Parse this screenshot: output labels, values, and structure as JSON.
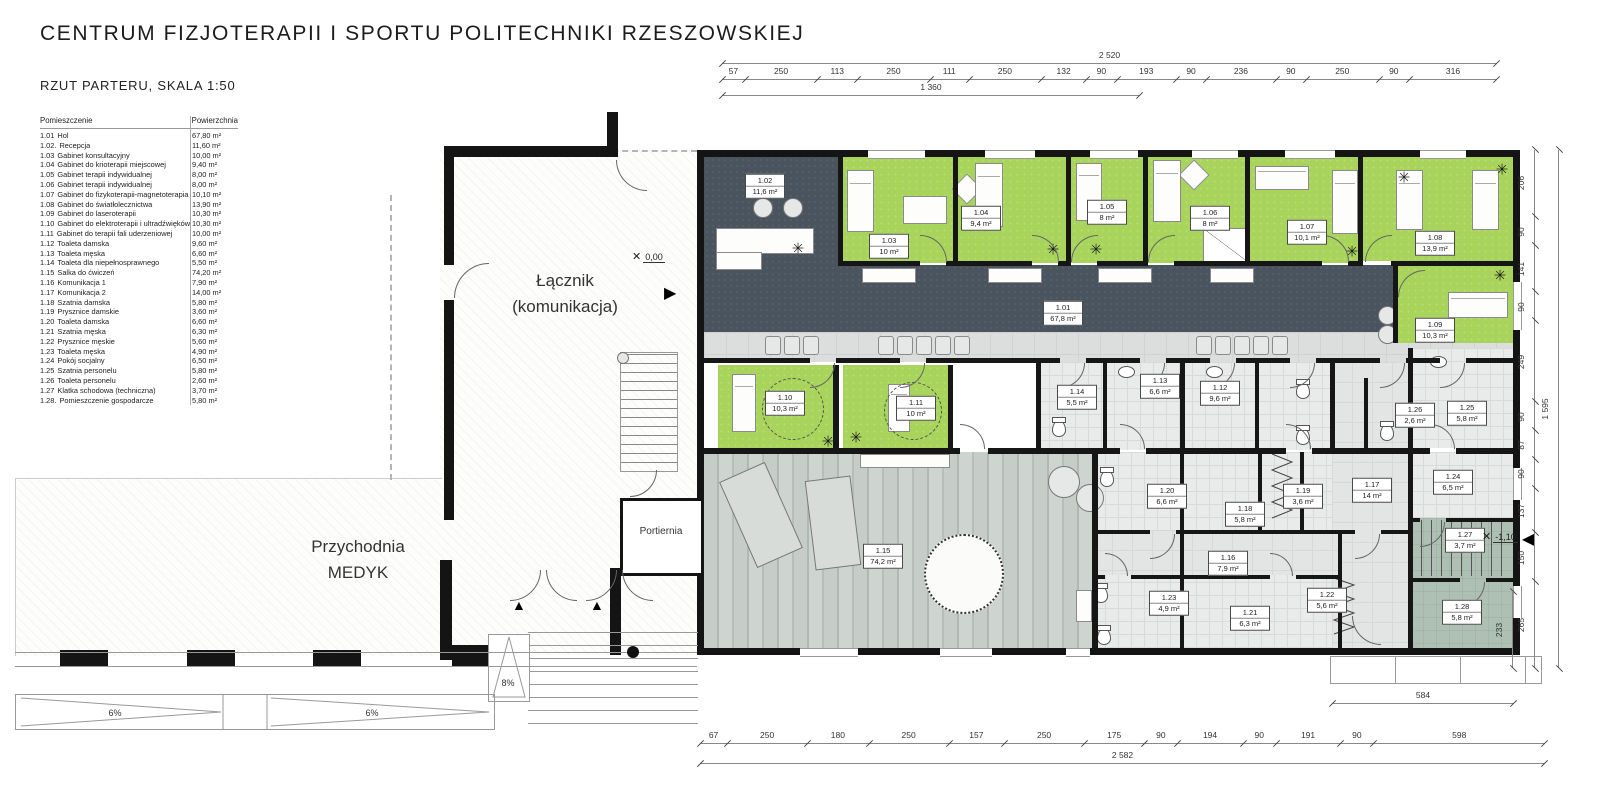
{
  "header": {
    "title": "CENTRUM FIZJOTERAPII I SPORTU POLITECHNIKI RZESZOWSKIEJ",
    "subtitle": "RZUT PARTERU, SKALA 1:50"
  },
  "legend": {
    "col_room": "Pomieszczenie",
    "col_area": "Powierzchnia",
    "rows": [
      {
        "id": "1.01",
        "name": "Hol",
        "area": "67,80 m²"
      },
      {
        "id": "1.02.",
        "name": "Recepcja",
        "area": "11,60 m²"
      },
      {
        "id": "1.03",
        "name": "Gabinet konsultacyjny",
        "area": "10,00 m²"
      },
      {
        "id": "1.04",
        "name": "Gabinet do krioterapii miejscowej",
        "area": "9,40 m²"
      },
      {
        "id": "1.05",
        "name": "Gabinet terapii indywidualnej",
        "area": "8,00 m²"
      },
      {
        "id": "1.06",
        "name": "Gabinet terapii indywidualnej",
        "area": "8,00 m²"
      },
      {
        "id": "1.07",
        "name": "Gabinet do fizykoterapii-magnetoterapia",
        "area": "10,10 m²"
      },
      {
        "id": "1.08",
        "name": "Gabinet do światłolecznictwa",
        "area": "13,90 m²"
      },
      {
        "id": "1.09",
        "name": "Gabinet do laseroterapii",
        "area": "10,30 m²"
      },
      {
        "id": "1.10",
        "name": "Gabinet do elektroterapii i ultradźwięków",
        "area": "10,30 m²"
      },
      {
        "id": "1.11",
        "name": "Gabinet do terapii fali uderzeniowej",
        "area": "10,00 m²"
      },
      {
        "id": "1.12",
        "name": "Toaleta damska",
        "area": "9,60 m²"
      },
      {
        "id": "1.13",
        "name": "Toaleta męska",
        "area": "6,60 m²"
      },
      {
        "id": "1.14",
        "name": "Toaleta dla niepełnosprawnego",
        "area": "5,50 m²"
      },
      {
        "id": "1.15",
        "name": "Salka do ćwiczeń",
        "area": "74,20 m²"
      },
      {
        "id": "1.16",
        "name": "Komunikacja 1",
        "area": "7,90 m²"
      },
      {
        "id": "1.17",
        "name": "Komunikacja 2",
        "area": "14,00 m²"
      },
      {
        "id": "1.18",
        "name": "Szatnia damska",
        "area": "5,80 m²"
      },
      {
        "id": "1.19",
        "name": "Prysznice damskie",
        "area": "3,60 m²"
      },
      {
        "id": "1.20",
        "name": "Toaleta damska",
        "area": "6,60 m²"
      },
      {
        "id": "1.21",
        "name": "Szatnia męska",
        "area": "6,30 m²"
      },
      {
        "id": "1.22",
        "name": "Prysznice męskie",
        "area": "5,60 m²"
      },
      {
        "id": "1.23",
        "name": "Toaleta męska",
        "area": "4,90 m²"
      },
      {
        "id": "1.24",
        "name": "Pokój socjalny",
        "area": "6,50 m²"
      },
      {
        "id": "1.25",
        "name": "Szatnia personelu",
        "area": "5,80 m²"
      },
      {
        "id": "1.26",
        "name": "Toaleta personelu",
        "area": "2,60 m²"
      },
      {
        "id": "1.27",
        "name": "Klatka schodowa (techniczna)",
        "area": "3,70 m²"
      },
      {
        "id": "1.28.",
        "name": "Pomieszczenie gospodarcze",
        "area": "5,80 m²"
      }
    ]
  },
  "rooms": [
    {
      "id": "1.01",
      "area": "67,8 m²"
    },
    {
      "id": "1.02",
      "area": "11,6 m²"
    },
    {
      "id": "1.03",
      "area": "10 m²"
    },
    {
      "id": "1.04",
      "area": "9,4 m²"
    },
    {
      "id": "1.05",
      "area": "8 m²"
    },
    {
      "id": "1.06",
      "area": "8 m²"
    },
    {
      "id": "1.07",
      "area": "10,1 m²"
    },
    {
      "id": "1.08",
      "area": "13,9 m²"
    },
    {
      "id": "1.09",
      "area": "10,3 m²"
    },
    {
      "id": "1.10",
      "area": "10,3 m²"
    },
    {
      "id": "1.11",
      "area": "10 m²"
    },
    {
      "id": "1.12",
      "area": "9,6 m²"
    },
    {
      "id": "1.13",
      "area": "6,6 m²"
    },
    {
      "id": "1.14",
      "area": "5,5 m²"
    },
    {
      "id": "1.15",
      "area": "74,2 m²"
    },
    {
      "id": "1.16",
      "area": "7,9 m²"
    },
    {
      "id": "1.17",
      "area": "14 m²"
    },
    {
      "id": "1.18",
      "area": "5,8 m²"
    },
    {
      "id": "1.19",
      "area": "3,6 m²"
    },
    {
      "id": "1.20",
      "area": "6,6 m²"
    },
    {
      "id": "1.21",
      "area": "6,3 m²"
    },
    {
      "id": "1.22",
      "area": "5,6 m²"
    },
    {
      "id": "1.23",
      "area": "4,9 m²"
    },
    {
      "id": "1.24",
      "area": "6,5 m²"
    },
    {
      "id": "1.25",
      "area": "5,8 m²"
    },
    {
      "id": "1.26",
      "area": "2,6 m²"
    },
    {
      "id": "1.27",
      "area": "3,7 m²"
    },
    {
      "id": "1.28",
      "area": "5,8 m²"
    }
  ],
  "site": {
    "lacznik_line1": "Łącznik",
    "lacznik_line2": "(komunikacja)",
    "przychodnia_line1": "Przychodnia",
    "przychodnia_line2": "MEDYK",
    "portiernia": "Portiernia",
    "level_entry": "0,00",
    "level_right": "-1,10",
    "ramp_side": "8%",
    "ramp_left_1": "6%",
    "ramp_left_2": "6%"
  },
  "icons": {
    "plant": "✳",
    "arrow_up": "▲",
    "arrow_right": "▶",
    "arrow_left": "◀",
    "cross": "✕"
  },
  "dimensions": {
    "top_total": "2 520",
    "top_segments": [
      57,
      250,
      113,
      250,
      111,
      250,
      132,
      90,
      193,
      90,
      236,
      90,
      250,
      90,
      316
    ],
    "top_partial": "1 360",
    "bottom_segments": [
      67,
      250,
      180,
      250,
      157,
      250,
      175,
      90,
      194,
      90,
      191,
      90,
      598
    ],
    "bottom_total": "2 582",
    "right_segments": [
      206,
      90,
      141,
      90,
      249,
      90,
      87,
      90,
      137,
      150,
      265
    ],
    "right_total": "1 595",
    "right_partial": "233",
    "terrace": "584"
  },
  "colors": {
    "room_green": "#a8d45c",
    "corridor_dark": "#4a545e",
    "corridor_light": "#dbdedd",
    "sanitary": "#e9ebea",
    "sage": "#aec0b4",
    "wall": "#161616"
  }
}
